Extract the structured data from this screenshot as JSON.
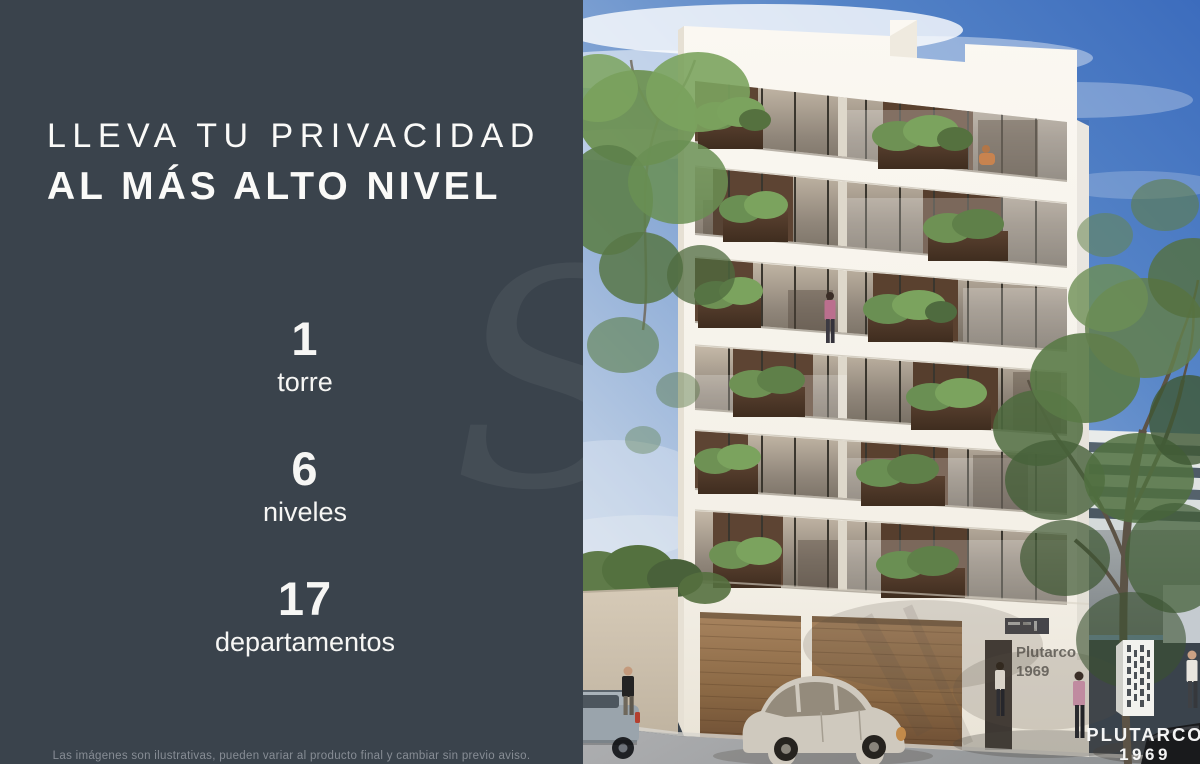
{
  "panel": {
    "headline": {
      "line1": "LLEVA TU PRIVACIDAD",
      "line2": "AL MÁS ALTO NIVEL"
    },
    "stats": [
      {
        "value": "1",
        "label": "torre"
      },
      {
        "value": "6",
        "label": "niveles"
      },
      {
        "value": "17",
        "label": "departamentos"
      }
    ],
    "watermark_letter": "S",
    "disclaimer": "Las imágenes son ilustrativas, pueden variar al producto final y cambiar sin previo aviso."
  },
  "photo": {
    "building_sign": {
      "line1": "Plutarco",
      "line2": "1969"
    },
    "logo": {
      "name": "PLUTARCO",
      "year": "1969"
    }
  },
  "colors": {
    "panel_bg": "#3a434c",
    "sky_deep": "#3c6cbd",
    "facade_white": "#f5f1e9",
    "wood_brown": "#8a6844",
    "plant_green": "#5f8049"
  }
}
